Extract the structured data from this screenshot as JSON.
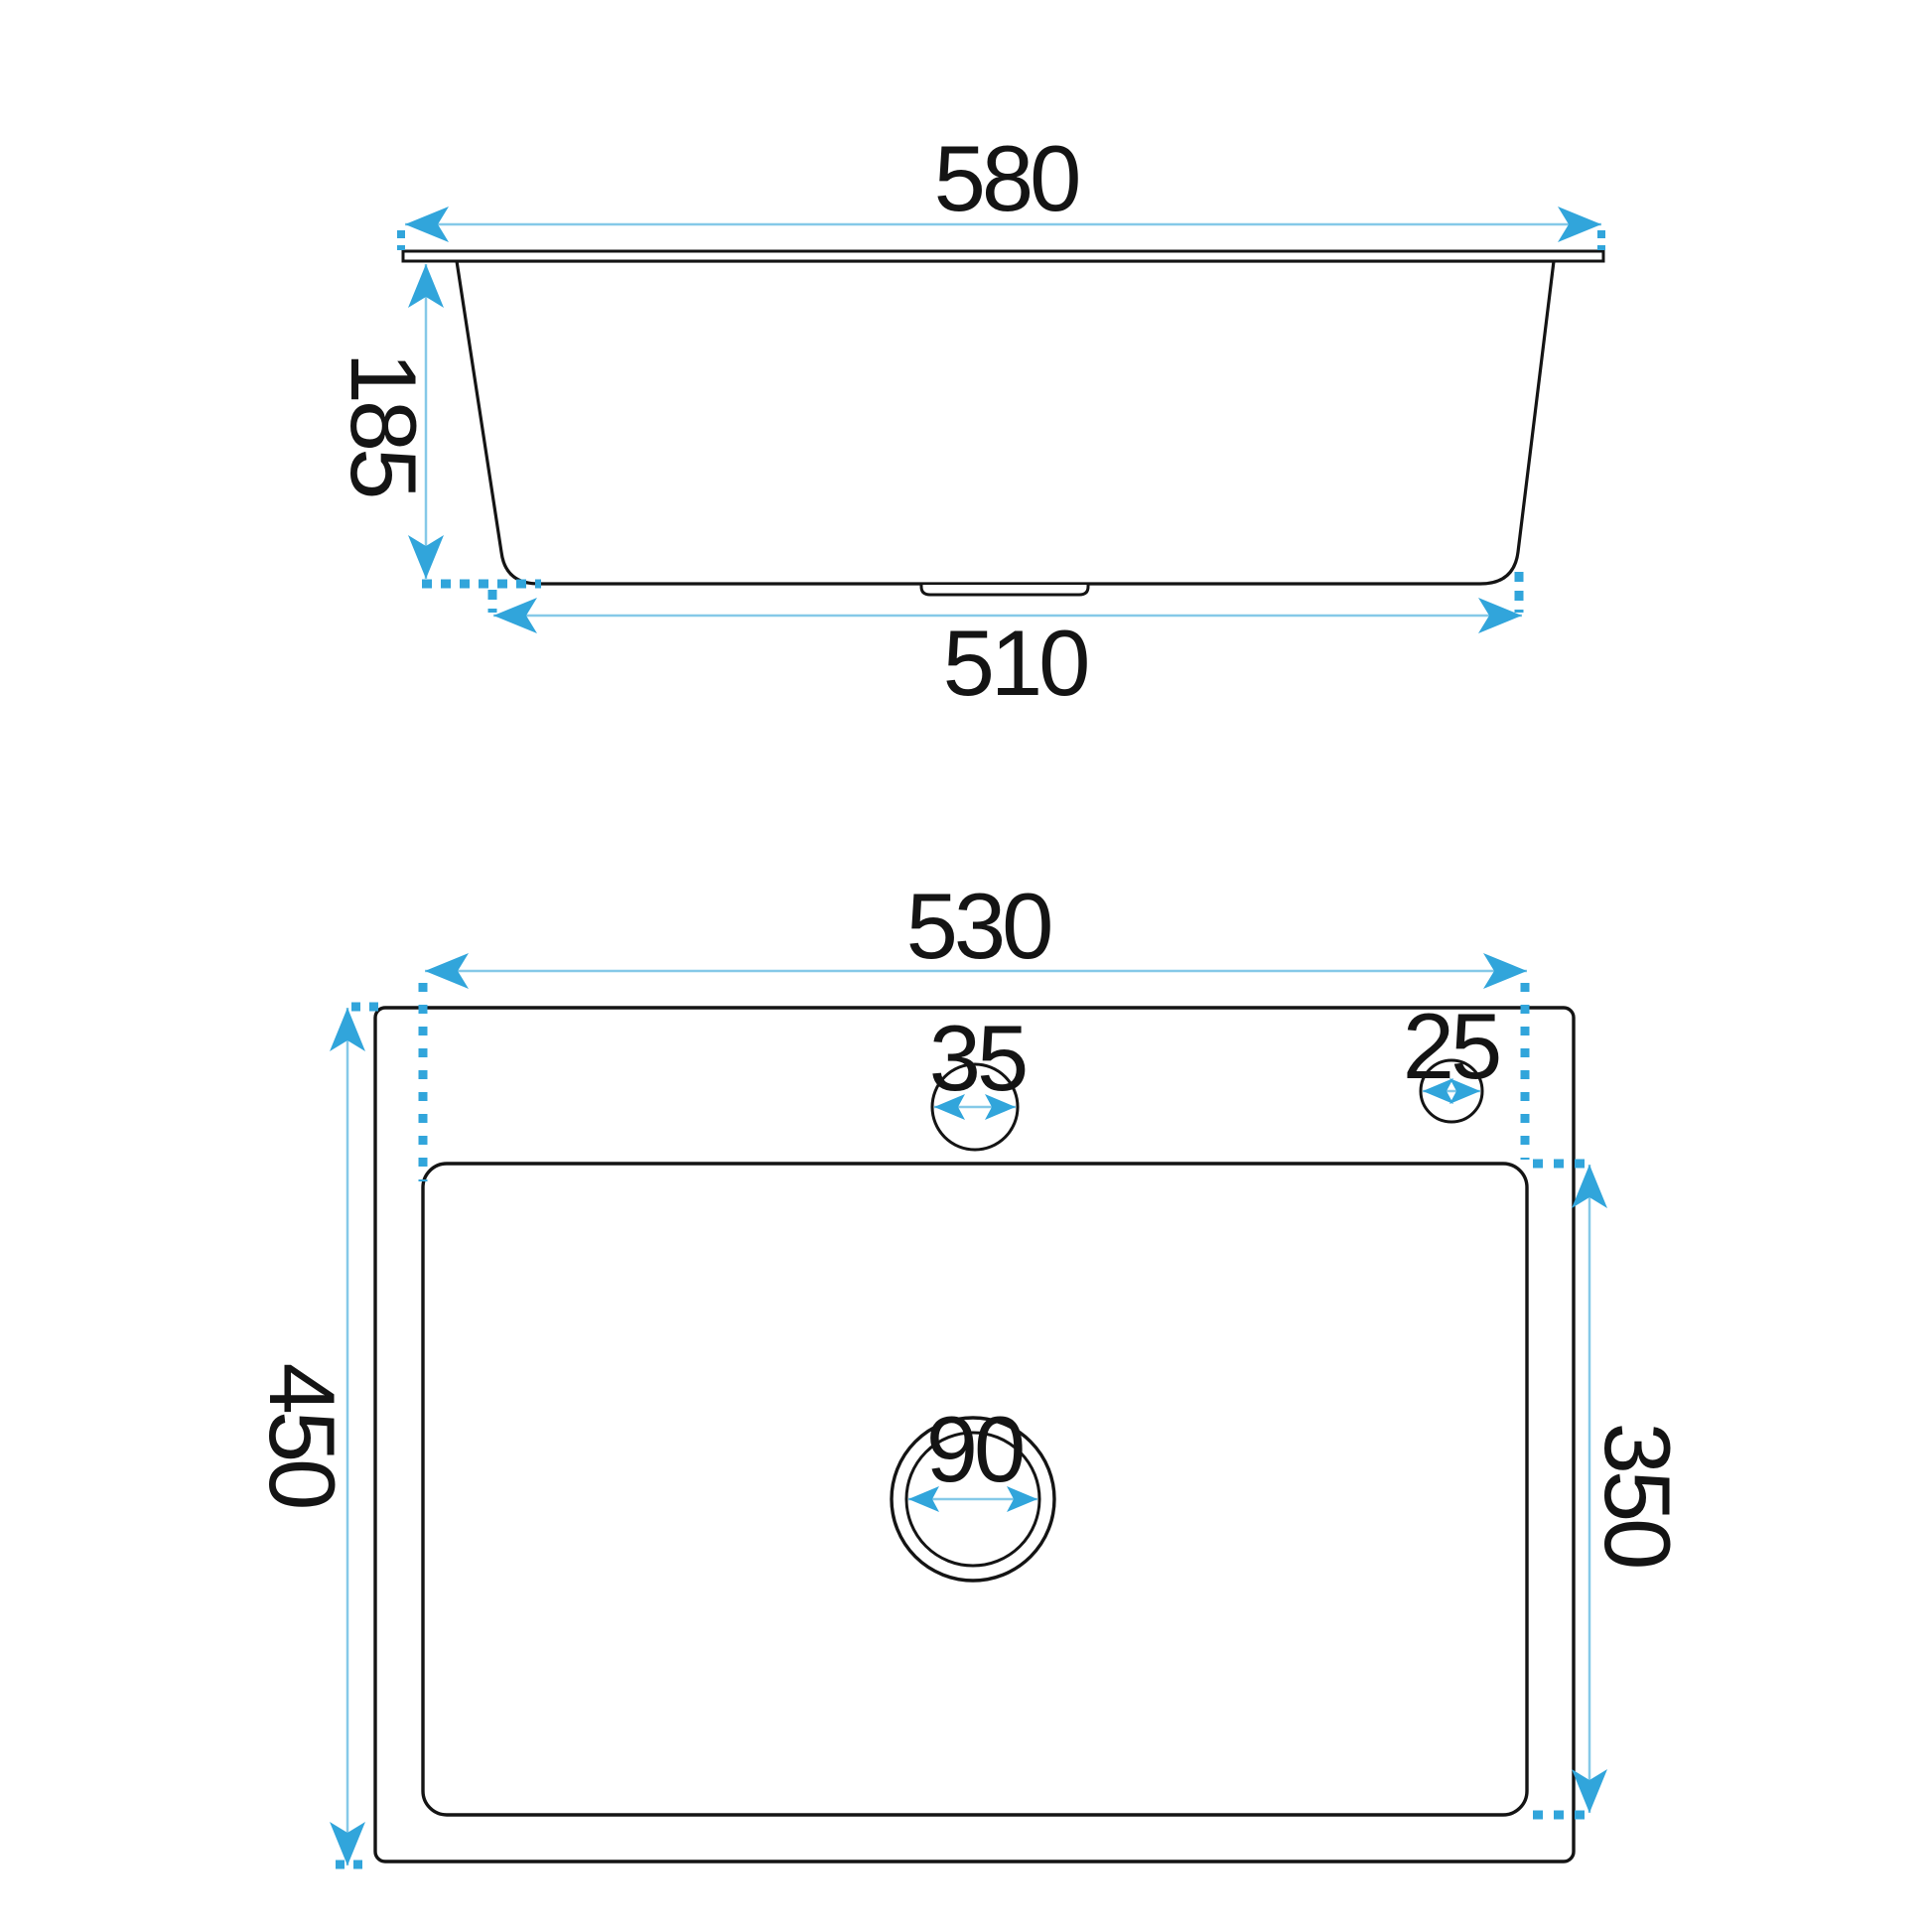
{
  "drawing": {
    "subject": "sink-dimension-drawing",
    "line_color": "#141414",
    "dim_line_color": "#85c9e8",
    "accent_color": "#31a5db",
    "side_view": {
      "dims": {
        "top_width": "580",
        "height": "185",
        "bottom_width": "510"
      }
    },
    "plan_view": {
      "dims": {
        "basin_width": "530",
        "faucet_hole": "35",
        "accessory_hole": "25",
        "drain": "90",
        "overall_depth": "450",
        "basin_depth": "350"
      }
    }
  }
}
